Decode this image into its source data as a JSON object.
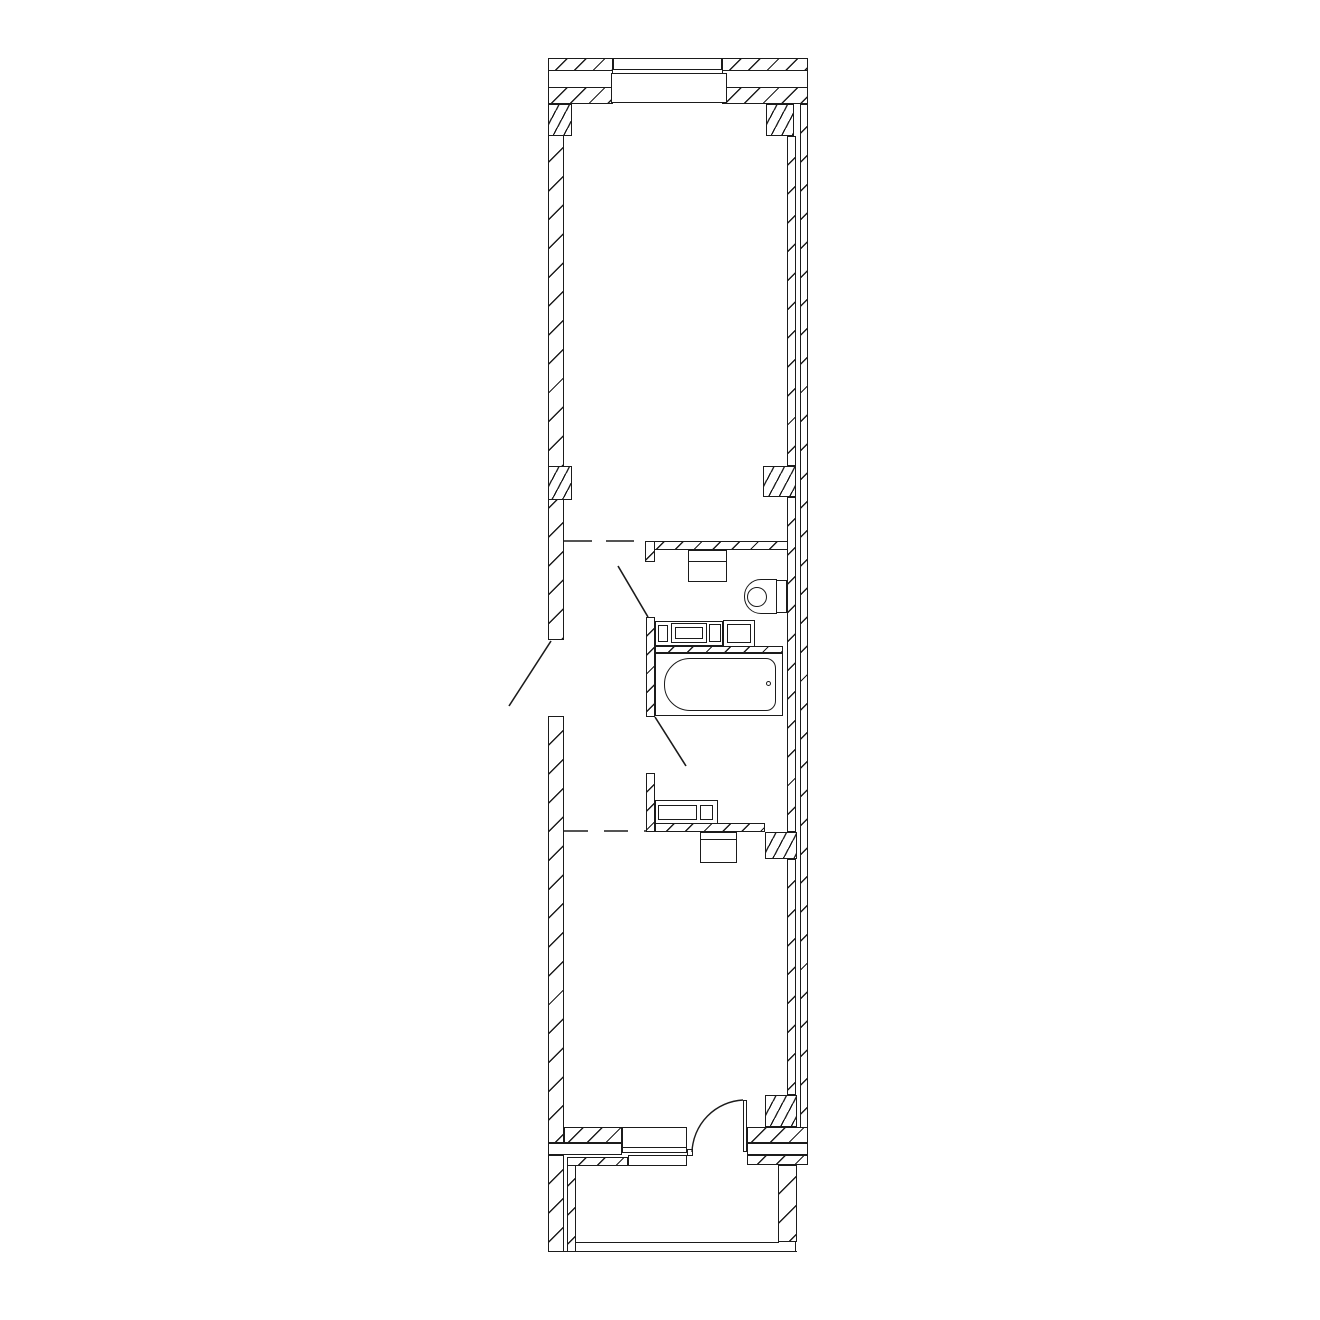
{
  "document": {
    "type": "architectural floor plan, monochrome line drawing",
    "background_color": "#ffffff",
    "line_color": "#1b1b1b",
    "rooms": [
      "upper-room",
      "hallway",
      "bathroom",
      "lower-room",
      "balcony"
    ],
    "fixtures": [
      "top-window",
      "entry-door",
      "washing-machine",
      "toilet",
      "vanity-cabinet",
      "storage-cabinet",
      "bathtub",
      "sink-cabinet",
      "ventilation-shaft",
      "bottom-window",
      "balcony-door",
      "balcony-sill"
    ],
    "door_count": 4,
    "window_count": 2,
    "dashed_zone_boundaries": 2
  }
}
